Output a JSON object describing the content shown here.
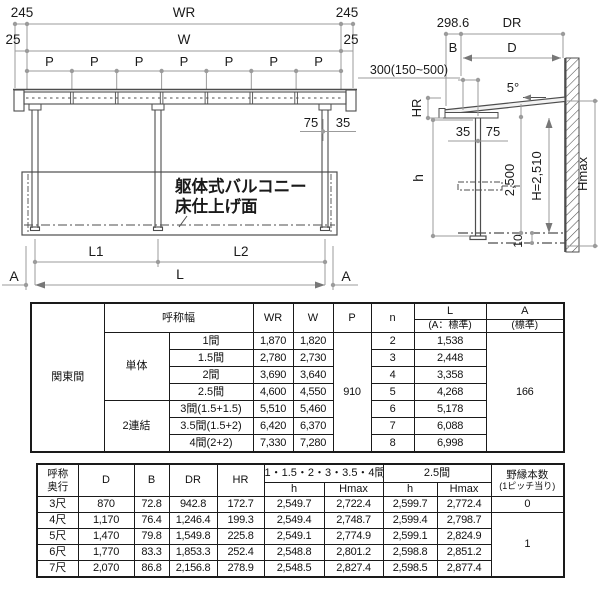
{
  "front_view": {
    "dim_245_left": "245",
    "dim_wr": "WR",
    "dim_245_right": "245",
    "dim_25_left": "25",
    "dim_w": "W",
    "dim_25_right": "25",
    "pitch_label": "P",
    "dim_75": "75",
    "dim_35": "35",
    "dim_l1": "L1",
    "dim_l2": "L2",
    "dim_l": "L",
    "section_a_left": "A",
    "section_a_right": "A",
    "balcony_note_line1": "躯体式バルコニー",
    "balcony_note_line2": "床仕上げ面"
  },
  "side_view": {
    "dim_298_6": "298.6",
    "dim_dr": "DR",
    "dim_b": "B",
    "dim_d": "D",
    "overhang_range": "300(150~500)",
    "roof_angle": "5°",
    "dim_hr": "HR",
    "dim_35": "35",
    "dim_75": "75",
    "dim_h": "h",
    "dim_2500": "2,500",
    "dim_h_eq": "H=2,510",
    "dim_hmax": "Hmax",
    "dim_10": "10"
  },
  "table1": {
    "region": "関東間",
    "headers": {
      "width": "呼称幅",
      "wr": "WR",
      "w": "W",
      "p": "P",
      "n": "n",
      "l": "L",
      "l_sub": "(A：標準)",
      "a": "A",
      "a_sub": "(標準)"
    },
    "group_single": "単体",
    "group_double": "2連結",
    "p_value": "910",
    "a_value": "166",
    "rows": [
      {
        "name": "1間",
        "wr": "1,870",
        "w": "1,820",
        "n": "2",
        "l": "1,538"
      },
      {
        "name": "1.5間",
        "wr": "2,780",
        "w": "2,730",
        "n": "3",
        "l": "2,448"
      },
      {
        "name": "2間",
        "wr": "3,690",
        "w": "3,640",
        "n": "4",
        "l": "3,358"
      },
      {
        "name": "2.5間",
        "wr": "4,600",
        "w": "4,550",
        "n": "5",
        "l": "4,268"
      },
      {
        "name": "3間(1.5+1.5)",
        "wr": "5,510",
        "w": "5,460",
        "n": "6",
        "l": "5,178"
      },
      {
        "name": "3.5間(1.5+2)",
        "wr": "6,420",
        "w": "6,370",
        "n": "7",
        "l": "6,088"
      },
      {
        "name": "4間(2+2)",
        "wr": "7,330",
        "w": "7,280",
        "n": "8",
        "l": "6,998"
      }
    ]
  },
  "table2": {
    "headers": {
      "depth_l1": "呼称",
      "depth_l2": "奥行",
      "d": "D",
      "b": "B",
      "dr": "DR",
      "hr": "HR",
      "group1": "1・1.5・2・3・3.5・4間",
      "group2": "2.5間",
      "h": "h",
      "hmax": "Hmax",
      "joists_l1": "野縁本数",
      "joists_l2": "(1ピッチ当り)"
    },
    "rows": [
      {
        "name": "3尺",
        "d": "870",
        "b": "72.8",
        "dr": "942.8",
        "hr": "172.7",
        "h1": "2,549.7",
        "hmax1": "2,722.4",
        "h2": "2,599.7",
        "hmax2": "2,772.4"
      },
      {
        "name": "4尺",
        "d": "1,170",
        "b": "76.4",
        "dr": "1,246.4",
        "hr": "199.3",
        "h1": "2,549.4",
        "hmax1": "2,748.7",
        "h2": "2,599.4",
        "hmax2": "2,798.7"
      },
      {
        "name": "5尺",
        "d": "1,470",
        "b": "79.8",
        "dr": "1,549.8",
        "hr": "225.8",
        "h1": "2,549.1",
        "hmax1": "2,774.9",
        "h2": "2,599.1",
        "hmax2": "2,824.9"
      },
      {
        "name": "6尺",
        "d": "1,770",
        "b": "83.3",
        "dr": "1,853.3",
        "hr": "252.4",
        "h1": "2,548.8",
        "hmax1": "2,801.2",
        "h2": "2,598.8",
        "hmax2": "2,851.2"
      },
      {
        "name": "7尺",
        "d": "2,070",
        "b": "86.8",
        "dr": "2,156.8",
        "hr": "278.9",
        "h1": "2,548.5",
        "hmax1": "2,827.4",
        "h2": "2,598.5",
        "hmax2": "2,877.4"
      }
    ],
    "joists_first": "0",
    "joists_rest": "1"
  },
  "colors": {
    "drawing_line": "#4d4d4d",
    "dimension_line": "#9b9b9b",
    "text": "#1a1a1a"
  }
}
